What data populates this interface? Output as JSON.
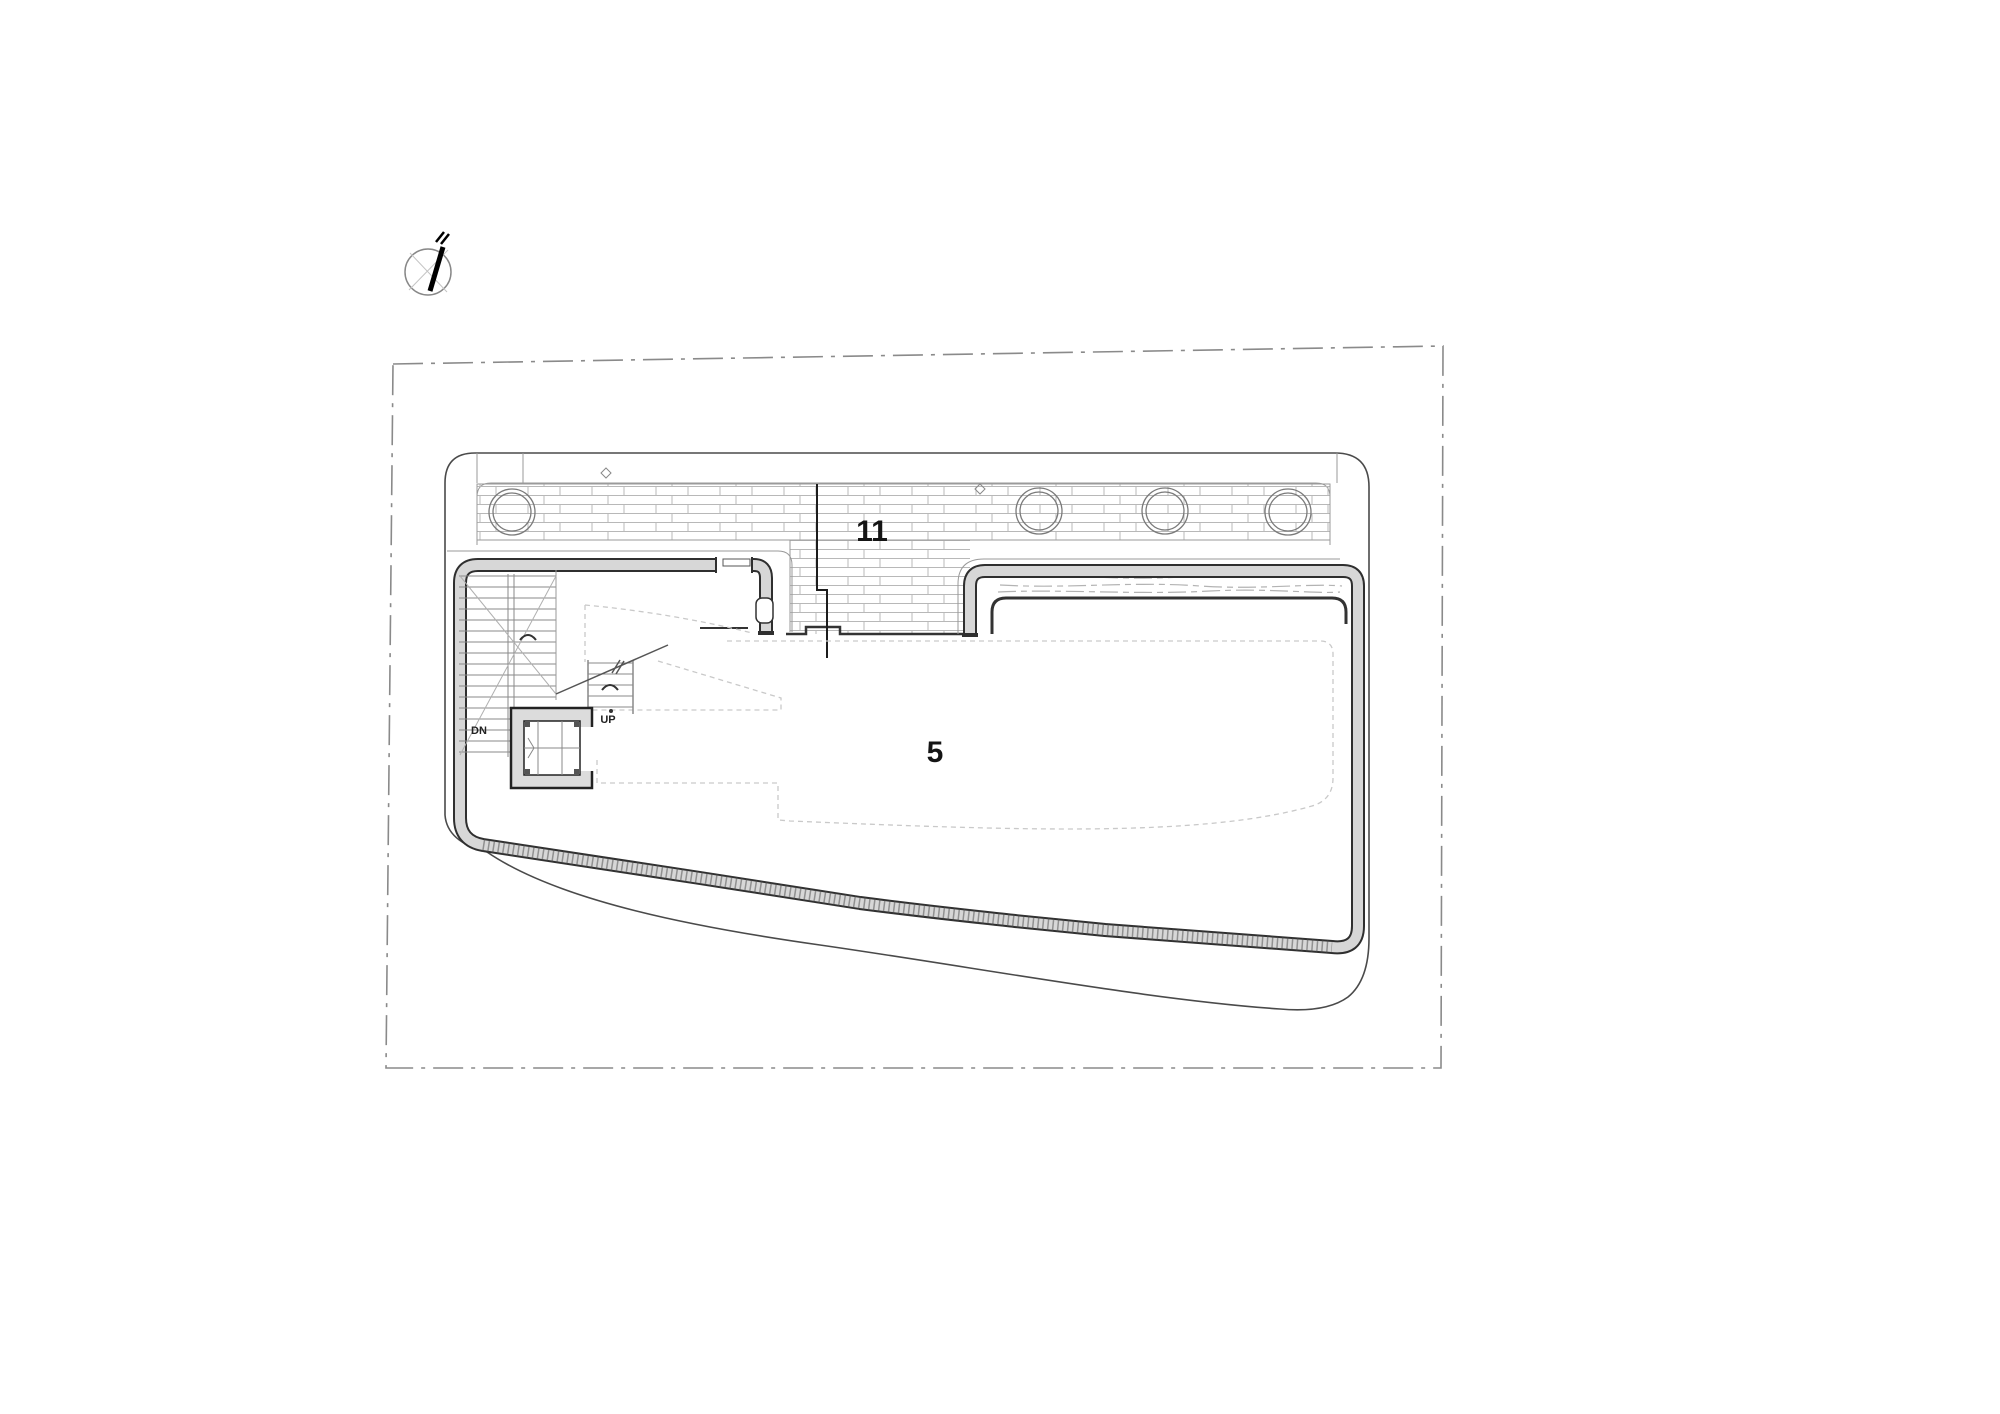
{
  "drawing": {
    "type": "architectural floor plan",
    "rooms": [
      {
        "id": "room-11",
        "label": "11"
      },
      {
        "id": "room-5",
        "label": "5"
      }
    ],
    "stairs": {
      "up_label": "UP",
      "down_label": "DN"
    },
    "palette": {
      "background": "#ffffff",
      "outline": "#4a4a4a",
      "wall_edge": "#2f2f2f",
      "wall_fill": "#d7d7d7",
      "brick_line": "#b8b8b8",
      "boundary_dash": "#8a8a8a",
      "hidden_dash": "#c9c9c9",
      "label_color": "#141414"
    }
  }
}
